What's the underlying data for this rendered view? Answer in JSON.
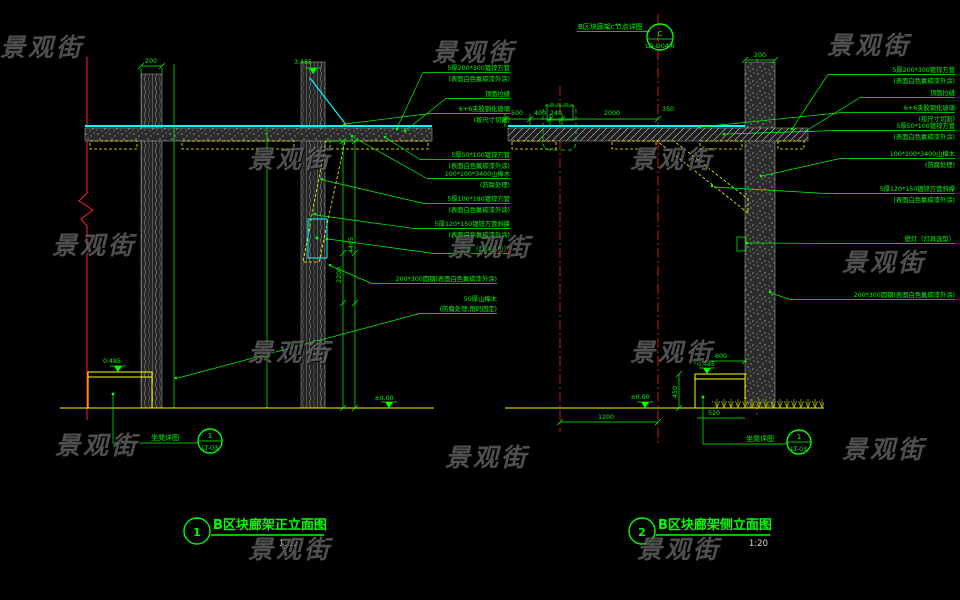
{
  "watermark": {
    "text": "景观街"
  },
  "left_view": {
    "title": {
      "num": "1",
      "text": "B区块廊架正立面图",
      "scale": "1:20"
    },
    "dims": {
      "col_width": "200",
      "h1": "4485",
      "h2": "2200"
    },
    "levels": {
      "top": "3.485",
      "bench": "0.485",
      "ground": "±0.00"
    },
    "bench_tag": {
      "name": "坐凳详图",
      "num": "1",
      "ref": "LT-03"
    },
    "labels": {
      "beam_l1": "5厚200*300镀锌方管",
      "beam_l2": "(表面白色氟碳漆外涂)",
      "groove": "顶面拉缝",
      "glass_l1": "6+6夹胶钢化玻璃",
      "glass_l2": "(按尺寸切割)",
      "purlin_l1": "5厚50*100镀锌方管",
      "purlin_l2": "(表面白色氟碳漆外涂)",
      "post_l1": "100*100*3400山樟木",
      "post_l2": "(防腐处理)",
      "beam2_l1": "5厚100*180镀锌方管",
      "beam2_l2": "(表面白色氟碳漆外涂)",
      "brace_l1": "5厚120*150镀锌方管斜撑",
      "brace_l2": "(表面白色氟碳漆外涂)",
      "lamp": "壁灯（灯具选型）",
      "steel": "200*300圆钢(表面白色氟碳漆外涂)",
      "bench_l1": "50厚山樟木",
      "bench_l2": "(防腐处理,角码固定)"
    }
  },
  "right_view": {
    "title": {
      "num": "2",
      "text": "B区块廊架侧立面图",
      "scale": "1:20"
    },
    "node_tag": {
      "label": "B区块廊架c节点详图",
      "num": "C",
      "ref": "LD-D04.6"
    },
    "dims": {
      "d500": "500",
      "d400": "400",
      "d240": "240",
      "d2000": "2000",
      "d350": "350",
      "col_width": "200",
      "bench_top": "600",
      "bench_bottom": "520",
      "bench_h": "450",
      "span": "1200"
    },
    "levels": {
      "bench": "0.485",
      "ground": "±0.00"
    },
    "bench_tag": {
      "name": "坐凳详图",
      "num": "1",
      "ref": "LT-03"
    },
    "labels": {
      "beam_l1": "5厚200*300镀锌方管",
      "beam_l2": "(表面白色氟碳漆外涂)",
      "groove": "顶面拉缝",
      "glass_l1": "6+6夹胶钢化玻璃",
      "glass_l2": "(按尺寸切割)",
      "purlin_l1": "5厚50*100镀锌方管",
      "purlin_l2": "(表面白色氟碳漆外涂)",
      "post_l1": "100*100*3400山樟木",
      "post_l2": "(防腐处理)",
      "brace_l1": "5厚120*150镀锌方管斜撑",
      "brace_l2": "(表面白色氟碳漆外涂)",
      "lamp": "壁灯（灯具选型）",
      "steel": "200*300圆钢(表面白色氟碳漆外涂)"
    }
  }
}
